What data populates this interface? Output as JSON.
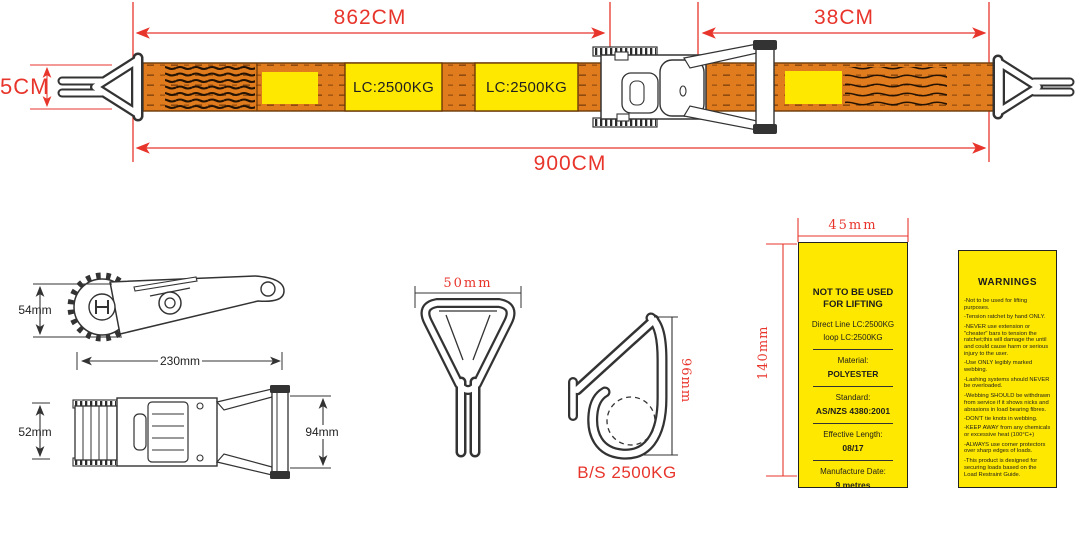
{
  "theme": {
    "red": "#e8352c",
    "orange": "#e07b1e",
    "yellow": "#ffe800",
    "ink": "#333333",
    "edge": "#6b3a08"
  },
  "strap_diagram": {
    "dim_main": "862CM",
    "dim_tail": "38CM",
    "dim_total": "900CM",
    "dim_width": "5CM",
    "webbing_label_1": "LC:2500KG",
    "webbing_label_2": "LC:2500KG"
  },
  "ratchet_side_view": {
    "height": "54mm",
    "length": "230mm"
  },
  "ratchet_bottom_view": {
    "width": "52mm",
    "handle_width": "94mm"
  },
  "delta_hook_view": {
    "width": "50mm"
  },
  "hook_view": {
    "height": "96mm",
    "strength": "B/S 2500KG"
  },
  "spec_label": {
    "dim_width": "45mm",
    "dim_height": "140mm",
    "title_line1": "NOT TO BE USED",
    "title_line2": "FOR LIFTING",
    "line1": "Direct Line LC:2500KG",
    "line2": "loop LC:2500KG",
    "material_label": "Material:",
    "material_value": "POLYESTER",
    "standard_label": "Standard:",
    "standard_value": "AS/NZS 4380:2001",
    "length_label": "Effective Length:",
    "length_value": "08/17",
    "date_label": "Manufacture Date:",
    "date_value": "9 metres"
  },
  "warnings_label": {
    "title": "WARNINGS",
    "items": [
      "-Not to be used for lifting purposes.",
      "-Tension ratchet by hand ONLY.",
      "-NEVER use extension or \"cheater\" bars to tension the ratchet;this will damage the until and could cause harm or serious injury to the user.",
      "-Use ONLY legibly marked webbing.",
      "-Lashing systems should NEVER be overloaded.",
      "-Webbing SHOULD be withdrawn from service if it shows nicks and abrasions in load bearing fibres.",
      "-DON'T tie knots in webbing.",
      "-KEEP AWAY from any chemicals or excessive heat (100°C+)",
      "-ALWAYS use corner protectors over sharp edges of loads.",
      "-This product is designed for securing loads based on the Load Restraint Guide."
    ]
  }
}
